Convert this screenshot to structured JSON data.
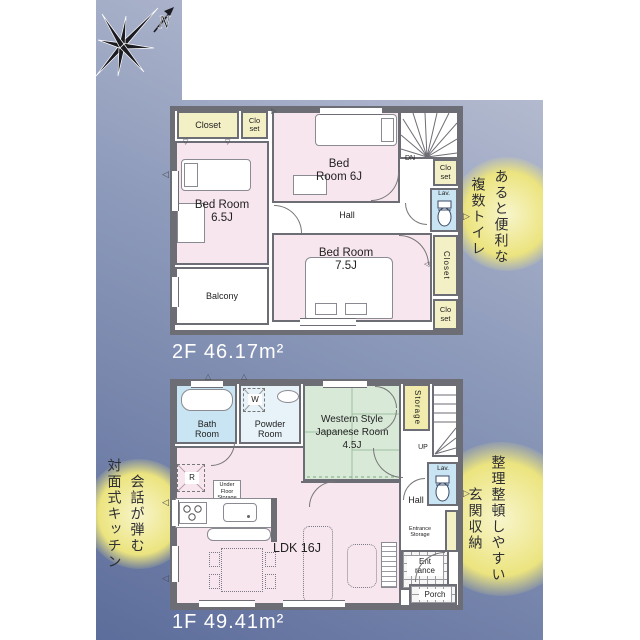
{
  "compass": {
    "north_label": "N"
  },
  "floor2": {
    "area_label": "2F 46.17m²",
    "rooms": {
      "closet_top": "Closet",
      "closet_top_small": "Clo set",
      "bedroom_65": "Bed Room 6.5J",
      "bedroom_6": "Bed Room 6J",
      "hall": "Hall",
      "stairs_dn": "DN",
      "closet_right_top": "Clo set",
      "lav": "Lav.",
      "closet_right_mid": "Closet",
      "closet_right_bottom": "Clo set",
      "bedroom_75": "Bed Room 7.5J",
      "balcony": "Balcony"
    },
    "callout": {
      "line1": "あると便利な",
      "line2": "複数トイレ"
    }
  },
  "floor1": {
    "area_label": "1F 49.41m²",
    "rooms": {
      "bath": "Bath Room",
      "powder": "Powder Room",
      "washer": "W",
      "japanese": "Western Style Japanese Room 4.5J",
      "storage": "Storage",
      "stairs_up": "UP",
      "lav": "Lav.",
      "hall": "Hall",
      "entrance_storage": "Entrance Storage",
      "entrance": "Ent rance",
      "porch": "Porch",
      "ldk": "LDK 16J",
      "fridge": "R",
      "under_floor": "Under Floor Storage"
    },
    "callout_left": {
      "line1": "会話が弾む",
      "line2": "対面式キッチン"
    },
    "callout_right": {
      "line1": "整理整頓しやすい",
      "line2": "玄関収納"
    }
  },
  "glyphs": {
    "tri_down": "▽",
    "tri_up": "△",
    "tri_right": "▷",
    "tri_left": "◁"
  },
  "colors": {
    "background_band": "#8e9bbb",
    "wall": "#6d6d75",
    "room_pink": "#f8e6ee",
    "closet_cream": "#f4f0c6",
    "wet_blue": "#c9e4f2",
    "tatami_green": "#d8e9d8",
    "storage_yellow": "#f1ecad",
    "highlight_yellow": "#ece47f",
    "area_text": "#ffffff"
  }
}
